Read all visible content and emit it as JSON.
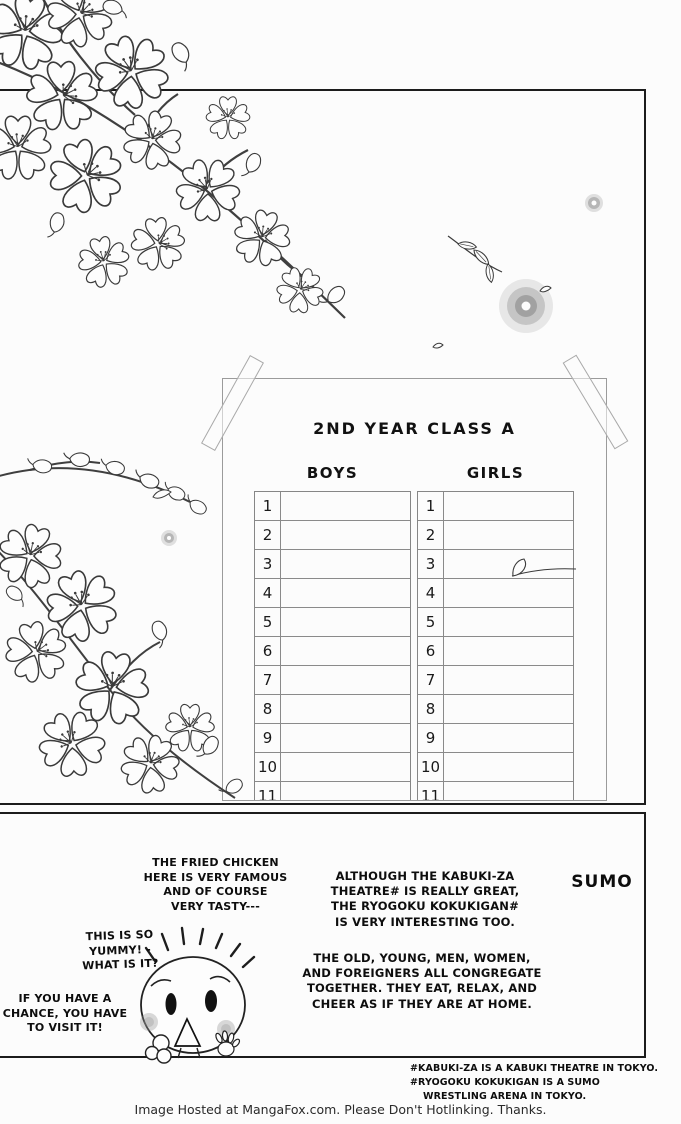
{
  "colors": {
    "ink": "#1c1c1c",
    "paper": "#fcfcfc",
    "sign_line": "#9b9b9b"
  },
  "roster_sign": {
    "title": "2ND YEAR CLASS A",
    "columns": [
      {
        "label": "BOYS",
        "rows": [
          "1",
          "2",
          "3",
          "4",
          "5",
          "6",
          "7",
          "8",
          "9",
          "10",
          "11"
        ]
      },
      {
        "label": "GIRLS",
        "rows": [
          "1",
          "2",
          "3",
          "4",
          "5",
          "6",
          "7",
          "8",
          "9",
          "10",
          "11"
        ]
      }
    ]
  },
  "bottom_panel": {
    "heading": "SUMO",
    "balloon_fried_chicken": "THE FRIED CHICKEN\nHERE IS VERY FAMOUS\nAND OF COURSE\nVERY TASTY---",
    "balloon_yummy": "THIS IS SO\nYUMMY! -\nWHAT IS IT?",
    "balloon_visit": "IF YOU HAVE A\nCHANCE, YOU HAVE\nTO VISIT IT!",
    "narration_kabuki": "ALTHOUGH THE KABUKI-ZA\nTHEATRE# IS REALLY GREAT,\nTHE RYOGOKU KOKUKIGAN#\nIS VERY INTERESTING TOO.",
    "narration_crowd": "THE OLD, YOUNG, MEN, WOMEN,\nAND FOREIGNERS ALL CONGREGATE\nTOGETHER. THEY EAT, RELAX, AND\nCHEER AS IF THEY ARE AT HOME."
  },
  "footnote": {
    "lines": [
      "#KABUKI-ZA IS A KABUKI THEATRE IN TOKYO.",
      "#RYOGOKU KOKUKIGAN IS A SUMO",
      "WRESTLING ARENA IN TOKYO."
    ]
  },
  "footer": {
    "text": "Image Hosted at MangaFox.com. Please Don't Hotlinking. Thanks."
  }
}
